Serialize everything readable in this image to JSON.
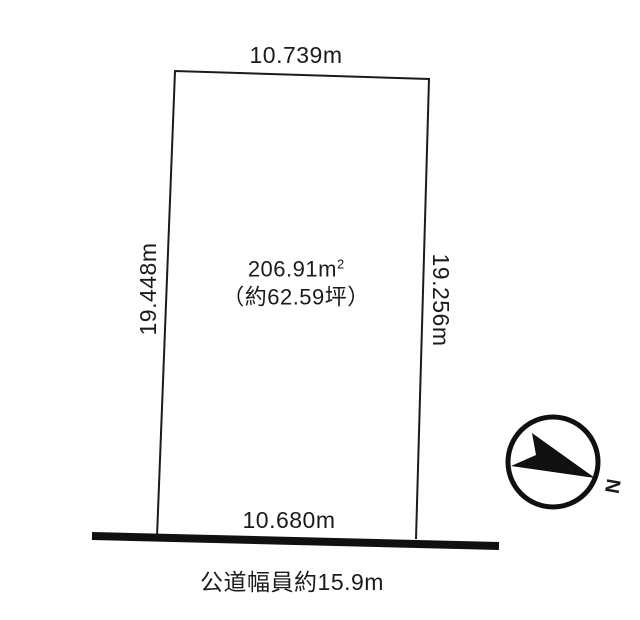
{
  "colors": {
    "ink": "#1b1b1b",
    "road": "#101010",
    "compass": "#101010",
    "background": "#ffffff"
  },
  "plot": {
    "top_dimension": "10.739m",
    "left_dimension": "19.448m",
    "right_dimension": "19.256m",
    "bottom_dimension": "10.680m",
    "area": {
      "number": "206.91",
      "unit_base": "m",
      "unit_exponent": "2",
      "tsubo": "（約62.59坪）"
    }
  },
  "road": {
    "label": "公道幅員約15.9m"
  },
  "compass": {
    "north_label": "N"
  }
}
